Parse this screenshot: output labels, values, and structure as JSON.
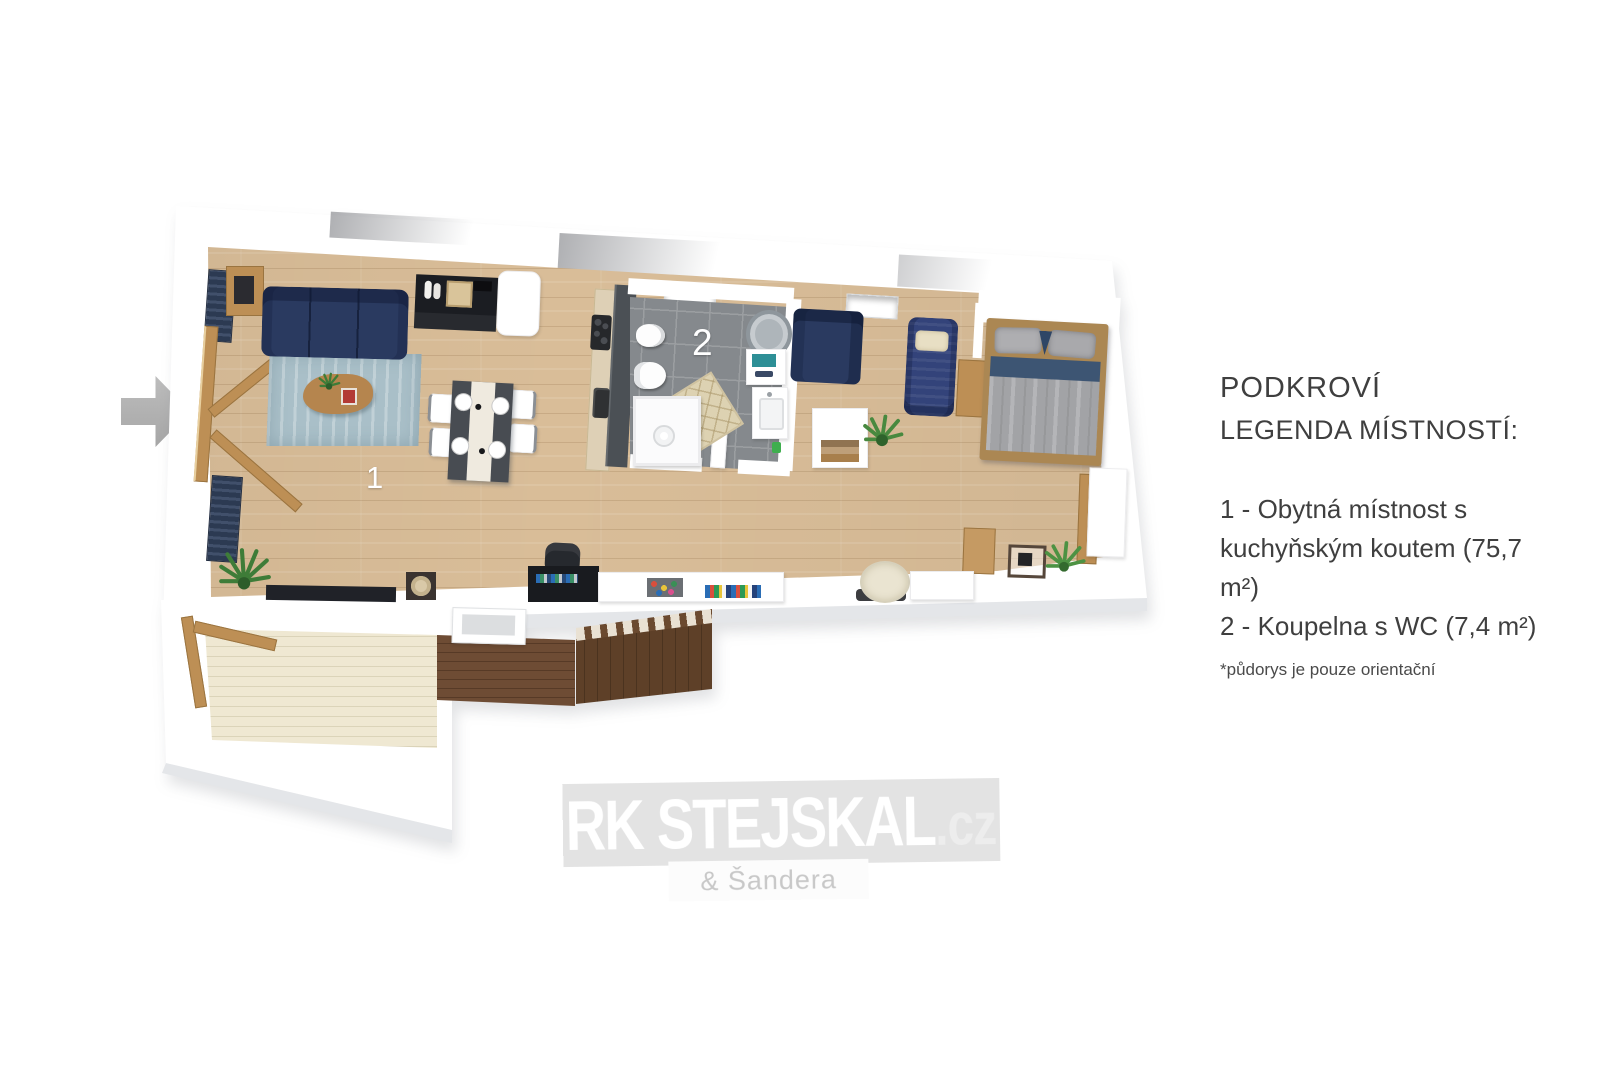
{
  "legend": {
    "title": "PODKROVÍ",
    "subtitle": "LEGENDA MÍSTNOSTÍ:",
    "item1_line1": "1 - Obytná místnost s",
    "item1_line2": "kuchyňským koutem (75,7 m²)",
    "item2": "2 - Koupelna s WC (7,4 m²)",
    "note": "*půdorys je pouze orientační"
  },
  "rooms": {
    "living": {
      "number": "1",
      "name": "Obytná místnost s kuchyňským koutem",
      "area_m2": "75,7"
    },
    "bathroom": {
      "number": "2",
      "name": "Koupelna s WC",
      "area_m2": "7,4"
    }
  },
  "watermark": {
    "brand": "RK STEJSKAL",
    "tld": ".cz",
    "sub": "& Šandera"
  },
  "icons": {
    "entrance_arrow": "arrow-right-icon",
    "plants": "potted-plant-icon"
  },
  "colors": {
    "wall": "#ffffff",
    "wall_edge": "#e4e6e9",
    "floor_wood": "#d9bd98",
    "bathroom_tile": "#85898d",
    "tile_grout": "#9b9ea1",
    "sofa_navy": "#2a3a60",
    "chaise_blue": "#33437a",
    "rug_blue": "#a9bfc8",
    "terrace_cream": "#efe8d2",
    "deck_brown": "#6e4c34",
    "stairs_brown": "#5e4028",
    "wood_furniture": "#bd8f55",
    "arrow_gray": "#b5b5b5",
    "text_dark": "#3f3f3f",
    "watermark_band": "#e3e3e3",
    "watermark_sub": "#c8c8c8",
    "black_furniture": "#1b1d22"
  }
}
